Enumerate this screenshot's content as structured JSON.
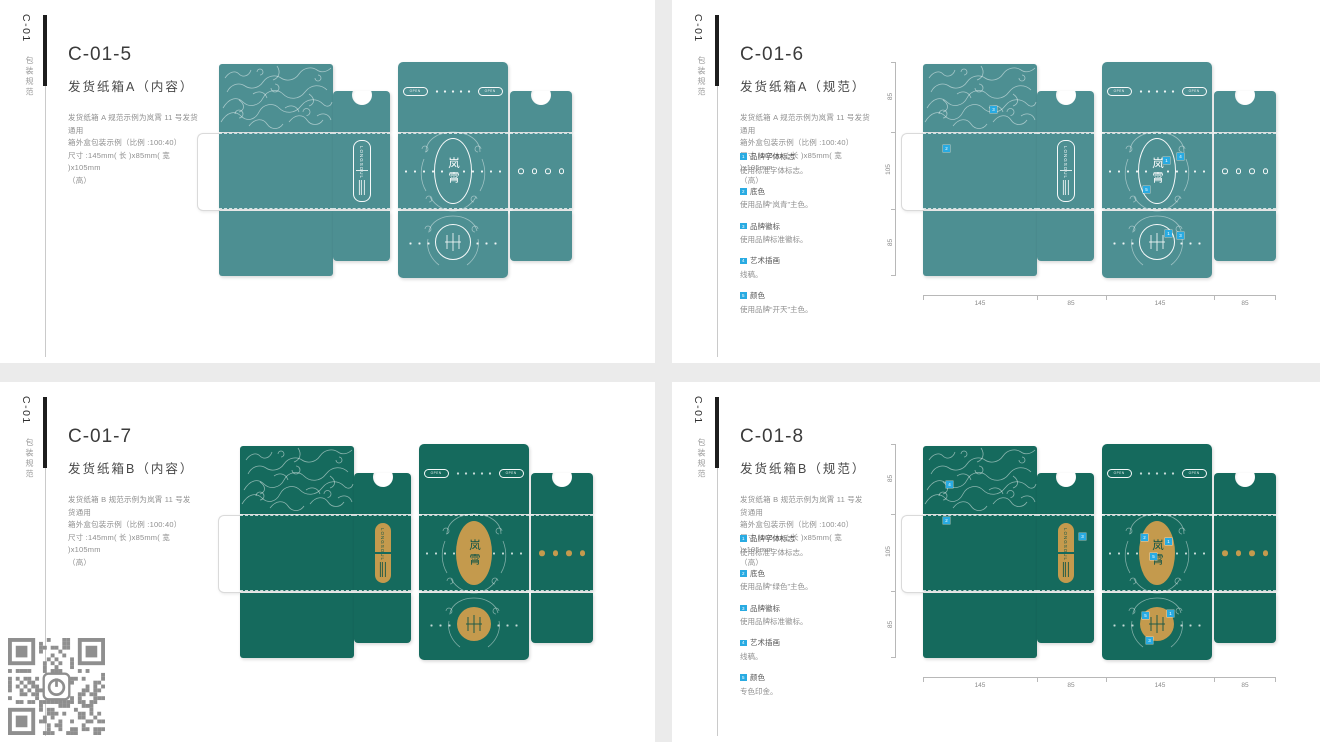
{
  "page": {
    "background": "#ebebeb",
    "panel_background": "#ffffff"
  },
  "colors": {
    "box_a_teal": "#4d8f92",
    "box_b_green": "#156a5d",
    "gold": "#c49a4d",
    "marker_blue": "#29abe2",
    "sidebar_bar": "#1d1d1d"
  },
  "dieline": {
    "brand_badge": "LONGSOUL",
    "emblem_text": "岚霄",
    "open_label": "OPEN"
  },
  "panels": [
    {
      "code": "C-01",
      "category": "包装规范",
      "variant": "A",
      "title": "C-01-5",
      "subtitle": "发货纸箱A（内容）",
      "desc": "发货纸箱 A 规范示例为岚霄 11 号发货通用\n箱外盒包装示例（比例 :100:40）\n尺寸 :145mm( 长 )x85mm( 宽 )x105mm\n（高）"
    },
    {
      "code": "C-01",
      "category": "包装规范",
      "variant": "A",
      "title": "C-01-6",
      "subtitle": "发货纸箱A（规范）",
      "desc": "发货纸箱 A 规范示例为岚霄 11 号发货通用\n箱外盒包装示例（比例 :100:40）\n尺寸 :145mm( 长 )x85mm( 宽 )x105mm\n（高）",
      "notes": [
        {
          "num": "1",
          "label": "品牌字体标志",
          "desc": "使用标准字体标志。"
        },
        {
          "num": "2",
          "label": "底色",
          "desc": "使用品牌“岚青”主色。"
        },
        {
          "num": "3",
          "label": "品牌徽标",
          "desc": "使用品牌标准徽标。"
        },
        {
          "num": "4",
          "label": "艺术插画",
          "desc": "线稿。"
        },
        {
          "num": "5",
          "label": "颜色",
          "desc": "使用品牌“开天”主色。"
        }
      ],
      "dims": {
        "widths": [
          "145",
          "85",
          "145",
          "85"
        ],
        "heights": [
          "85",
          "105",
          "85"
        ]
      },
      "markers": [
        {
          "n": "3",
          "x": 89,
          "y": 44
        },
        {
          "n": "2",
          "x": 42,
          "y": 83
        },
        {
          "n": "4",
          "x": 276,
          "y": 91
        },
        {
          "n": "1",
          "x": 262,
          "y": 95
        },
        {
          "n": "5",
          "x": 242,
          "y": 124
        },
        {
          "n": "1",
          "x": 264,
          "y": 168
        },
        {
          "n": "3",
          "x": 276,
          "y": 170
        }
      ]
    },
    {
      "code": "C-01",
      "category": "包装规范",
      "variant": "B",
      "title": "C-01-7",
      "subtitle": "发货纸箱B（内容）",
      "desc": "发货纸箱 B 规范示例为岚霄 11 号发货通用\n箱外盒包装示例（比例 :100:40）\n尺寸 :145mm( 长 )x85mm( 宽 )x105mm\n（高）"
    },
    {
      "code": "C-01",
      "category": "包装规范",
      "variant": "B",
      "title": "C-01-8",
      "subtitle": "发货纸箱B（规范）",
      "desc": "发货纸箱 B 规范示例为岚霄 11 号发货通用\n箱外盒包装示例（比例 :100:40）\n尺寸 :145mm( 长 )x85mm( 宽 )x105mm\n（高）",
      "notes": [
        {
          "num": "1",
          "label": "品牌字体标志",
          "desc": "使用标准字体标志。"
        },
        {
          "num": "2",
          "label": "底色",
          "desc": "使用品牌“绿色”主色。"
        },
        {
          "num": "3",
          "label": "品牌徽标",
          "desc": "使用品牌标准徽标。"
        },
        {
          "num": "4",
          "label": "艺术插画",
          "desc": "线稿。"
        },
        {
          "num": "5",
          "label": "颜色",
          "desc": "专色印金。"
        }
      ],
      "dims": {
        "widths": [
          "145",
          "85",
          "145",
          "85"
        ],
        "heights": [
          "85",
          "105",
          "85"
        ]
      },
      "markers": [
        {
          "n": "4",
          "x": 45,
          "y": 37
        },
        {
          "n": "2",
          "x": 42,
          "y": 73
        },
        {
          "n": "3",
          "x": 178,
          "y": 89
        },
        {
          "n": "2",
          "x": 240,
          "y": 90
        },
        {
          "n": "1",
          "x": 264,
          "y": 94
        },
        {
          "n": "5",
          "x": 249,
          "y": 109
        },
        {
          "n": "5",
          "x": 241,
          "y": 168
        },
        {
          "n": "1",
          "x": 266,
          "y": 166
        },
        {
          "n": "3",
          "x": 245,
          "y": 193
        }
      ]
    }
  ],
  "qr": {
    "present": true,
    "color": "#8f8f8f"
  }
}
